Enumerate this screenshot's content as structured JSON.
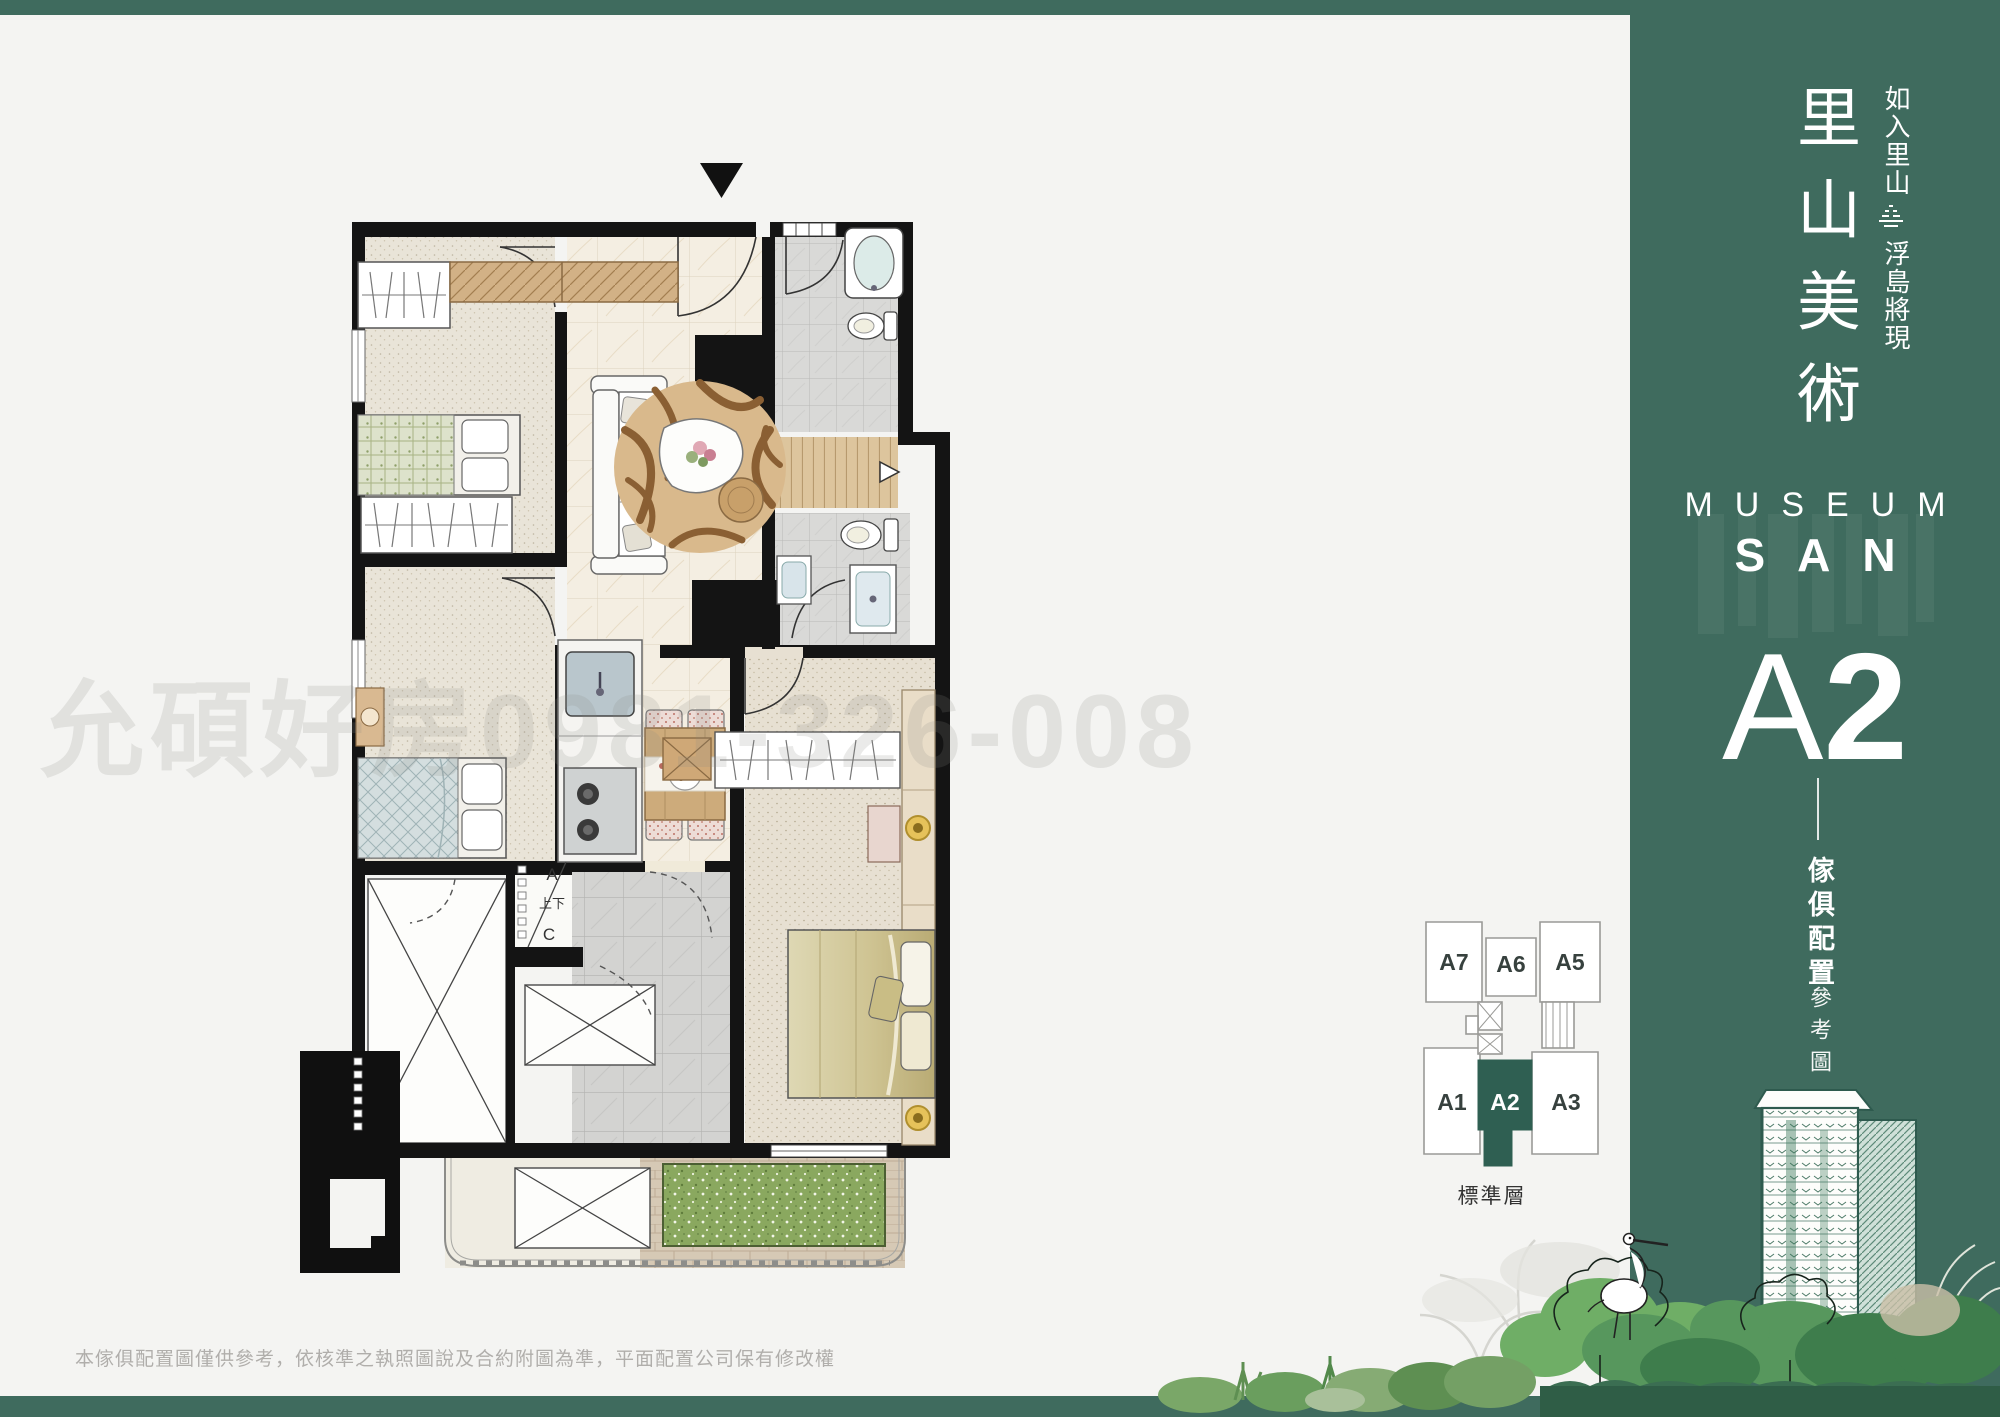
{
  "page": {
    "background": "#f4f4f2",
    "accent_green": "#3f6b5e",
    "keyplan_green": "#2f5f52",
    "watermark": "允碩好房0981-326-008",
    "disclaimer": "本傢俱配置圖僅供參考，依核準之執照圖說及合約附圖為準，平面配置公司保有修改權"
  },
  "panel": {
    "title": "里山美術",
    "slogan_top": "如入里山",
    "slogan_bottom": "浮島將現",
    "brand_top": "MUSEUM",
    "brand_mid": "SAN",
    "unit_letter": "A",
    "unit_number": "2",
    "caption_bold": "傢俱配置",
    "caption_light": "參考圖"
  },
  "keyplan": {
    "floor_label": "標準層",
    "highlighted_unit": "A2",
    "units": [
      {
        "label": "A7"
      },
      {
        "label": "A6"
      },
      {
        "label": "A5"
      },
      {
        "label": "A1"
      },
      {
        "label": "A2"
      },
      {
        "label": "A3"
      }
    ]
  },
  "floorplan": {
    "stair": {
      "a": "A",
      "updown": "上下",
      "c": "C"
    }
  }
}
